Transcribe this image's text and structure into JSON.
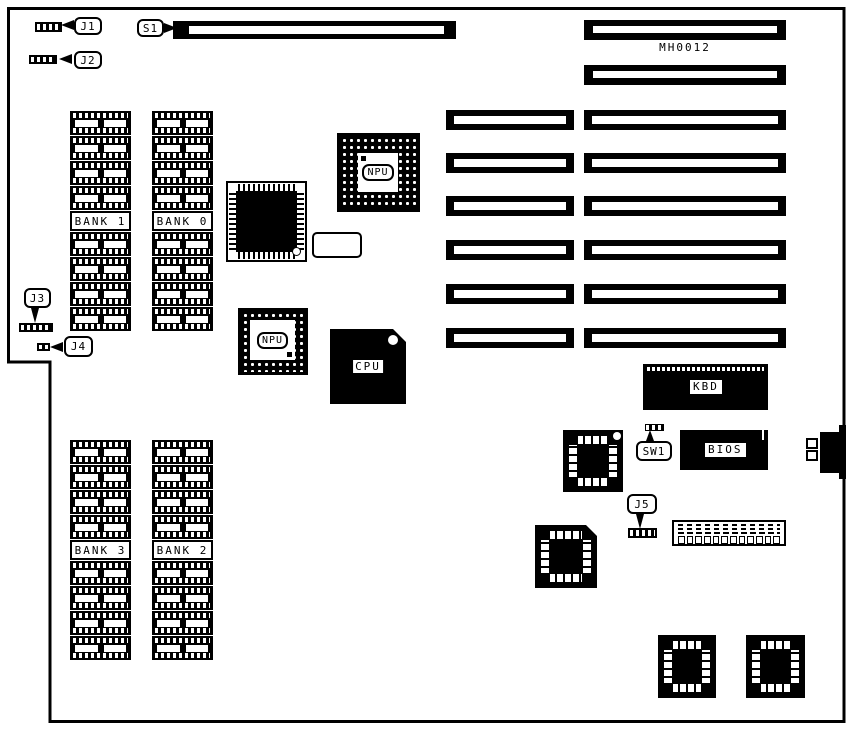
{
  "board": {
    "code": "MH0012"
  },
  "jumpers": {
    "j1": "J1",
    "j2": "J2",
    "j3": "J3",
    "j4": "J4",
    "j5": "J5"
  },
  "switch": {
    "sw1": "SW1"
  },
  "slot_label": {
    "s1": "S1"
  },
  "chips": {
    "npu_top": "NPU",
    "npu_mid": "NPU",
    "cpu": "CPU",
    "kbd": "KBD",
    "bios": "BIOS"
  },
  "banks": [
    {
      "label": "BANK 1",
      "dip_chips": 8
    },
    {
      "label": "BANK 0",
      "dip_chips": 8
    },
    {
      "label": "BANK 3",
      "dip_chips": 8
    },
    {
      "label": "BANK 2",
      "dip_chips": 8
    }
  ],
  "slots": {
    "expansion_rows": 6,
    "short_per_row": 1,
    "long_per_row": 1,
    "top_long_slots": 2,
    "s1_slots": 1
  },
  "connectors": {
    "edge_boxes": 2,
    "header_sockets": 12
  }
}
